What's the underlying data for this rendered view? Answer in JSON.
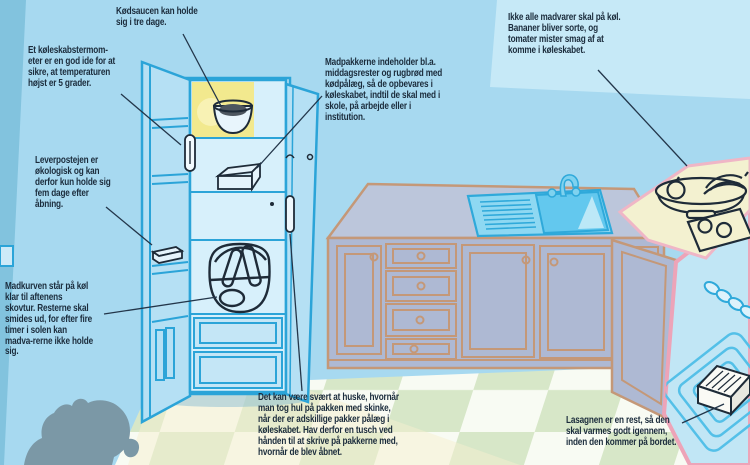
{
  "annotations": {
    "meat_sauce": {
      "text": "Kødsaucen kan holde\nsig i tre dage."
    },
    "thermometer": {
      "text": "Et køleskabstermom-\neter er en god ide for at\nsikre, at temperaturen\nhøjst er 5 grader."
    },
    "liver_pate": {
      "text": "Leverpostejen er\nøkologisk og kan\nderfor kun holde sig\nfem dage efter\nåbning."
    },
    "picnic_basket": {
      "text": "Madkurven står på køl\nklar til aftenens\nskovtur. Resterne skal\nsmides ud, for efter fire\ntimer i solen kan\nmadva-rerne ikke holde\nsig."
    },
    "lunch_boxes": {
      "text": "Madpakkerne indeholder bl.a.\nmiddagsrester og rugbrød med\nkødpålæg, så de opbevares i\nkøleskabet, indtil de skal med i\nskole, på arbejde eller i\ninstitution."
    },
    "room_temp_foods": {
      "text": "Ikke alle madvarer skal på køl.\nBananer bliver sorte, og\ntomater mister smag af at\nkomme i køleskabet."
    },
    "marker_pen": {
      "text": "Det kan være svært at huske, hvornår\nman tog hul på pakken med skinke,\nnår der er adskillige pakker pålæg i\nkøleskabet. Hav derfor en tusch ved\nhånden til at skrive på pakkerne med,\nhvornår de blev åbnet."
    },
    "lasagna": {
      "text": "Lasagnen er en rest, så den\nskal varmes godt igennem,\ninden den kommer på bordet."
    }
  },
  "colors": {
    "wall": "#a7d9f0",
    "wall_light": "#c6e9f7",
    "wall_left": "#82c3de",
    "fridge_outline": "#2ba4d8",
    "fridge_fill": "#c7e8f7",
    "fridge_interior": "#d7f0fb",
    "glow_yellow": "#f2e98e",
    "cabinet_fill": "#aeb9d3",
    "cabinet_outline": "#c49878",
    "sink_blue": "#63c8ee",
    "counter_cream": "#f3f1d0",
    "trim_pink": "#efb6c6",
    "oven_blue": "#c1e6f5",
    "floor_green": "#d7e7c8",
    "floor_white": "#f8fbf3",
    "pig_gray": "#7b98a6",
    "ink": "#1e2b38",
    "text": "#1b2c3c"
  }
}
